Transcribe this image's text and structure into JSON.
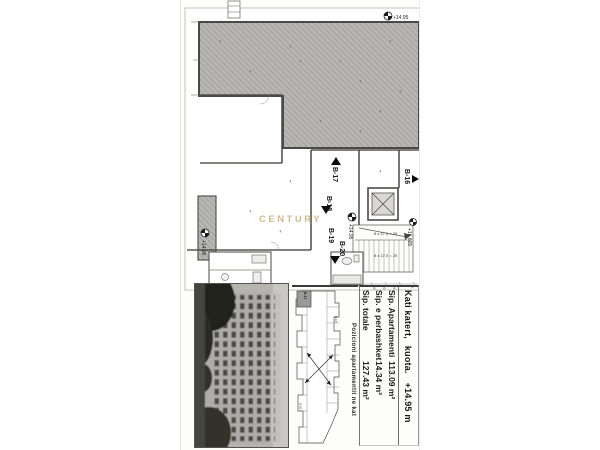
{
  "colors": {
    "hatch_gray": "#b7b6b2",
    "wall_dark": "#4b4a45",
    "watermark_tan": "#c9b584",
    "photo_tree_dark": "#23221f"
  },
  "plan": {
    "watermark": "CENTURY",
    "markers": {
      "b16": "B-16",
      "b17": "B-17",
      "b18": "B-18",
      "b19": "B-19",
      "b20": "B-20"
    },
    "elevations": {
      "terrace": "+14.95",
      "stair_mid": "+14.95",
      "landing": "+16.605",
      "balcony": "+14.95"
    },
    "stair_note_upper": "8 x 17,5 = 29",
    "stair_note_lower": "8 x 17,5 = 29",
    "dims": {
      "d1": "59",
      "d2": "59",
      "d3": "59",
      "d4": "K"
    }
  },
  "info_table": {
    "row1": {
      "part1": "Kati katert,",
      "part2": "kuota.",
      "part3": "+14.95 m"
    },
    "rows": [
      {
        "label": "Sip. Apartamenti",
        "value": "113.09 m²"
      },
      {
        "label": "Sip. e perbashket",
        "value": "14.34 m²"
      },
      {
        "label": "Sip. totale",
        "value": "127.43 m²"
      }
    ]
  },
  "key_plan": {
    "caption": "Pozicioni apartamentit ne kat",
    "unit_label": "B-17",
    "label_2": "B-18",
    "label_3": "B-20"
  }
}
